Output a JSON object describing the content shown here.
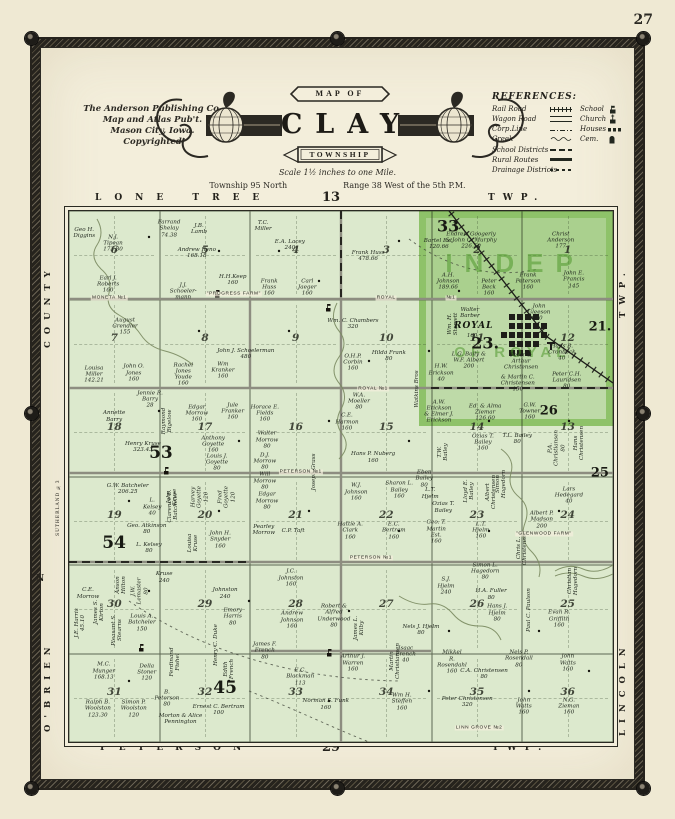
{
  "page": {
    "number": "27"
  },
  "publisher": {
    "line1": "The Anderson Publishing Co.",
    "line2": "Map and Atlas Pub't.",
    "line3": "Mason City, Iowa.",
    "line4": "Copyrighted"
  },
  "title": {
    "map_of": "MAP OF",
    "name": "CLAY",
    "township": "TOWNSHIP",
    "scale": "Scale 1½ inches to one Mile.",
    "township_line": "Township 95 North",
    "range_line": "Range 38 West of the 5th P.M."
  },
  "references": {
    "title": "REFERENCES:",
    "rows": [
      {
        "l": "Rail Road",
        "ls": "rail",
        "r": "School",
        "rs": "school"
      },
      {
        "l": "Wagon Road",
        "ls": "road",
        "r": "Church",
        "rs": "church"
      },
      {
        "l": "Corp.Line",
        "ls": "corp",
        "r": "Houses",
        "rs": "houses"
      },
      {
        "l": "Creek",
        "ls": "creek",
        "r": "Cem.",
        "rs": "cem"
      },
      {
        "l": "School Districts",
        "ls": "district"
      },
      {
        "l": "Rural Routes",
        "ls": "rural"
      },
      {
        "l": "Drainage Districts",
        "ls": "drain"
      }
    ]
  },
  "edges": {
    "top_word": "LONE TREE",
    "top_num": "13",
    "top_twp": "TWP.",
    "bottom_word": "PETERSON",
    "bottom_num": "29",
    "bottom_twp": "TWP.",
    "left_top": "COUNTY",
    "left_bottom": "O'BRIEN",
    "left_small": "SUTHERLAND №3",
    "left_n": "N",
    "right_top": "TWP.",
    "right_bottom": "LINCOLN"
  },
  "map": {
    "overlay": {
      "line1": "INDEP",
      "line2": "OF ROYAL"
    },
    "town": {
      "name": "ROYAL",
      "acres": "160"
    },
    "section_numbers": [
      [
        6,
        5,
        4,
        3,
        2,
        1
      ],
      [
        7,
        8,
        9,
        10,
        11,
        12
      ],
      [
        18,
        17,
        16,
        15,
        14,
        13
      ],
      [
        19,
        20,
        21,
        22,
        23,
        24
      ],
      [
        30,
        29,
        28,
        27,
        26,
        25
      ],
      [
        31,
        32,
        33,
        34,
        35,
        36
      ]
    ],
    "district_numbers": [
      {
        "n": "33",
        "x": 69.7,
        "y": 2.8,
        "s": 16
      },
      {
        "n": "21.",
        "x": 97.6,
        "y": 21.8,
        "s": 13
      },
      {
        "n": "23.",
        "x": 76.5,
        "y": 24.8,
        "s": 16
      },
      {
        "n": "26",
        "x": 88.2,
        "y": 37.6,
        "s": 13
      },
      {
        "n": "25",
        "x": 97.6,
        "y": 49.4,
        "s": 13
      },
      {
        "n": "53",
        "x": 16.9,
        "y": 45.5,
        "s": 17
      },
      {
        "n": "54",
        "x": 8.3,
        "y": 62.6,
        "s": 17
      },
      {
        "n": "45",
        "x": 28.7,
        "y": 89.8,
        "s": 17
      }
    ],
    "road_labels": [
      {
        "t": "MONETA №1",
        "x": 7.4,
        "y": 16.4
      },
      {
        "t": "ROYAL",
        "x": 58.3,
        "y": 16.4
      },
      {
        "t": "№1",
        "x": 70.2,
        "y": 16.4
      },
      {
        "t": "ROYAL №1",
        "x": 55.9,
        "y": 33.5
      },
      {
        "t": "PETERSON №1",
        "x": 42.6,
        "y": 49.1
      },
      {
        "t": "PETERSON №1",
        "x": 55.5,
        "y": 65.4
      },
      {
        "t": "LINN GROVE №2",
        "x": 75.4,
        "y": 97.4
      },
      {
        "t": "\"PROGRESS FARM\"",
        "x": 30.3,
        "y": 15.6
      },
      {
        "t": "\"GLENWOOD FARM\"",
        "x": 87.3,
        "y": 60.9
      }
    ],
    "parcels": [
      {
        "n": "Geo H.|Diggins",
        "x": 2.8,
        "y": 4.1
      },
      {
        "n": "N.J.|Tipean|173.80",
        "x": 8.1,
        "y": 6.2
      },
      {
        "n": "Earl J.|Roberts|160",
        "x": 7.2,
        "y": 13.9
      },
      {
        "n": "Farrand|Shelay|74.38",
        "x": 18.4,
        "y": 3.4
      },
      {
        "n": "J.B.|Lamb",
        "x": 23.9,
        "y": 3.4
      },
      {
        "n": "Andrew Reno|168.18",
        "x": 23.5,
        "y": 7.9
      },
      {
        "n": "J.J.|Schoeler-|mann",
        "x": 21.0,
        "y": 15.2
      },
      {
        "n": "H.H.Keep|160",
        "x": 30.1,
        "y": 13.0
      },
      {
        "n": "T.C.|Miller",
        "x": 35.7,
        "y": 2.8
      },
      {
        "n": "E.A. Lacey|240",
        "x": 40.6,
        "y": 6.4
      },
      {
        "n": "Frank|Huss|160",
        "x": 36.8,
        "y": 14.5
      },
      {
        "n": "Carl|Jaeger|160",
        "x": 43.8,
        "y": 14.5
      },
      {
        "n": "Frank Huss|478.66",
        "x": 55.0,
        "y": 8.5
      },
      {
        "n": "Endrew Googerly|& John C. Murphy|226.50",
        "x": 73.9,
        "y": 5.6
      },
      {
        "n": "Christ|Anderson|177",
        "x": 90.4,
        "y": 5.6
      },
      {
        "n": "Bartel Est.|120.66",
        "x": 68.0,
        "y": 6.2
      },
      {
        "n": "A.H.|Johnson|189.66",
        "x": 69.7,
        "y": 13.3
      },
      {
        "n": "Peter|Beck|160",
        "x": 77.2,
        "y": 14.5
      },
      {
        "n": "Frank|Peterson|160",
        "x": 84.4,
        "y": 13.3
      },
      {
        "n": "John E.|Francis|145",
        "x": 92.8,
        "y": 13.0
      },
      {
        "n": "August|Grendler|155",
        "x": 10.3,
        "y": 21.8
      },
      {
        "n": "John J. Schoelerman|480",
        "x": 32.5,
        "y": 26.9
      },
      {
        "n": "Wm. C. Chambers|320",
        "x": 52.2,
        "y": 21.2
      },
      {
        "n": "Walter|Barber",
        "x": 73.7,
        "y": 19.2
      },
      {
        "n": "John|Gleeson|40",
        "x": 86.4,
        "y": 19.2
      },
      {
        "n": "Wm. H.|Starrett",
        "x": 70.6,
        "y": 21.2,
        "v": 1
      },
      {
        "n": "Louisa|Miller|142.21",
        "x": 4.6,
        "y": 30.8
      },
      {
        "n": "John O.|Jones|160",
        "x": 11.9,
        "y": 30.6
      },
      {
        "n": "Rachel|Jones|Youde|160",
        "x": 21.0,
        "y": 30.8
      },
      {
        "n": "Wm|Kranker|160",
        "x": 28.3,
        "y": 30.1
      },
      {
        "n": "O.H.P.|Corbin|160",
        "x": 52.2,
        "y": 28.6
      },
      {
        "n": "Hilda Frank|80",
        "x": 58.8,
        "y": 27.3
      },
      {
        "n": "W.A.|Moeller|80",
        "x": 53.3,
        "y": 35.9
      },
      {
        "n": "Watkins Bros",
        "x": 64.0,
        "y": 33.5,
        "v": 1
      },
      {
        "n": "H.W.|Erickson|40",
        "x": 68.4,
        "y": 30.6
      },
      {
        "n": "L.G. Baily &|W.F. Albert|200",
        "x": 73.5,
        "y": 28.2
      },
      {
        "n": "Peter &|Arthur|Christensen",
        "x": 83.1,
        "y": 28.4
      },
      {
        "n": "& Martin C.|Christensen|150",
        "x": 82.5,
        "y": 32.5
      },
      {
        "n": "Peter C.H.|Lauridsen|80",
        "x": 91.5,
        "y": 32.0
      },
      {
        "n": "Hans B.|Cronbeck|40",
        "x": 90.6,
        "y": 26.7
      },
      {
        "n": "A.W.|Erickson|& Elmer J.|Erickson",
        "x": 68.0,
        "y": 37.8
      },
      {
        "n": "Ed. & Alma|Ziemar|126.60",
        "x": 76.5,
        "y": 38.0
      },
      {
        "n": "G.W.|Towner|160",
        "x": 84.7,
        "y": 37.8
      },
      {
        "n": "Annette|Barry",
        "x": 8.3,
        "y": 38.7
      },
      {
        "n": "Jennie R.|Barry|28",
        "x": 14.9,
        "y": 35.5
      },
      {
        "n": "Henry Kruse|323.43",
        "x": 13.6,
        "y": 44.4
      },
      {
        "n": "Raymond|Bigelow",
        "x": 18.0,
        "y": 39.5,
        "v": 1
      },
      {
        "n": "Edgar|Morrow|160",
        "x": 23.5,
        "y": 38.2
      },
      {
        "n": "Jule|Franker|160",
        "x": 30.1,
        "y": 37.8
      },
      {
        "n": "Anthony|Goyette|160",
        "x": 26.5,
        "y": 44.0
      },
      {
        "n": "Louis J.|Goyette|80",
        "x": 27.2,
        "y": 47.4
      },
      {
        "n": "Horace E.|Fields|160",
        "x": 36.0,
        "y": 38.2
      },
      {
        "n": "Walter|Morrow|80",
        "x": 36.4,
        "y": 43.2
      },
      {
        "n": "D.J.|Morrow|80",
        "x": 36.0,
        "y": 47.2
      },
      {
        "n": "Will|Morrow|80",
        "x": 36.0,
        "y": 50.9
      },
      {
        "n": "Edgar|Morrow|80",
        "x": 36.4,
        "y": 54.7
      },
      {
        "n": "Joseph Grass",
        "x": 45.0,
        "y": 49.2,
        "v": 1
      },
      {
        "n": "C.E.|Harmon|160",
        "x": 51.1,
        "y": 39.8
      },
      {
        "n": "Hans P. Nuberg|160",
        "x": 55.9,
        "y": 46.4
      },
      {
        "n": "W.J.|Johnson|160",
        "x": 52.8,
        "y": 53.0
      },
      {
        "n": "Sharon L.|Bailey|160",
        "x": 60.7,
        "y": 52.6
      },
      {
        "n": "Eben|Bailey|80",
        "x": 65.3,
        "y": 50.5
      },
      {
        "n": "T.W.|Bailey",
        "x": 68.8,
        "y": 45.3,
        "v": 1
      },
      {
        "n": "L.T.|Hjelm",
        "x": 66.4,
        "y": 53.2
      },
      {
        "n": "Ozias T.|Bailey",
        "x": 68.8,
        "y": 55.8
      },
      {
        "n": "Ozias T.|Bailey|160",
        "x": 76.1,
        "y": 43.6
      },
      {
        "n": "T.L. Bailey|80",
        "x": 82.4,
        "y": 42.9
      },
      {
        "n": "P.A.|Christiansen|80",
        "x": 89.7,
        "y": 44.7,
        "v": 1
      },
      {
        "n": "Hans|Christensen",
        "x": 93.8,
        "y": 43.6,
        "v": 1
      },
      {
        "n": "Lars|Hedegard|40",
        "x": 91.9,
        "y": 53.6
      },
      {
        "n": "Lloyd E.|Bailey",
        "x": 73.5,
        "y": 52.8,
        "v": 1
      },
      {
        "n": "Albert|Christensen",
        "x": 77.6,
        "y": 53.0,
        "v": 1
      },
      {
        "n": "Simon|Hagedorn",
        "x": 79.4,
        "y": 51.4,
        "v": 1
      },
      {
        "n": "L.T.|Hjelm|160",
        "x": 75.7,
        "y": 60.2
      },
      {
        "n": "Albert P.|Madson|200",
        "x": 86.9,
        "y": 58.2
      },
      {
        "n": "Chris L.|Christensen",
        "x": 83.3,
        "y": 63.5,
        "v": 1
      },
      {
        "n": "G.W. Batcheler|206.25",
        "x": 10.8,
        "y": 52.4
      },
      {
        "n": "L.|Kelsey|40",
        "x": 15.3,
        "y": 55.8
      },
      {
        "n": "Clarence E.|Batcheler",
        "x": 19.1,
        "y": 55.6,
        "v": 1
      },
      {
        "n": "Geo. Atkinson|80",
        "x": 14.3,
        "y": 59.8
      },
      {
        "n": "L. Kelsey|80",
        "x": 14.7,
        "y": 63.5
      },
      {
        "n": "John|Kruse",
        "x": 18.9,
        "y": 53.8,
        "v": 1
      },
      {
        "n": "Harvey|Goyette|120",
        "x": 24.1,
        "y": 53.9,
        "v": 1
      },
      {
        "n": "Fred|Goyette|120",
        "x": 29.0,
        "y": 53.9,
        "v": 1
      },
      {
        "n": "Louisa|Kruse",
        "x": 22.8,
        "y": 62.6,
        "v": 1
      },
      {
        "n": "John H.|Snyder|160",
        "x": 27.8,
        "y": 62.0
      },
      {
        "n": "Kruse|240",
        "x": 17.5,
        "y": 69.0
      },
      {
        "n": "Pearley|Morrow",
        "x": 35.8,
        "y": 60.0
      },
      {
        "n": "C.P. Taft",
        "x": 41.2,
        "y": 60.2
      },
      {
        "n": "Hattie A.|Clark|160",
        "x": 51.7,
        "y": 60.3
      },
      {
        "n": "E.C.|Bertram|160",
        "x": 59.7,
        "y": 60.3
      },
      {
        "n": "Geo. T.|Martin|Est.|160",
        "x": 67.5,
        "y": 60.5
      },
      {
        "n": "S.J.|Hjelm|240",
        "x": 69.3,
        "y": 70.7
      },
      {
        "n": "Simon L.|Hagedorn|80",
        "x": 76.5,
        "y": 67.9
      },
      {
        "n": "H.A. Fuller|80",
        "x": 77.6,
        "y": 72.2
      },
      {
        "n": "Hans J.|Hjelm|80",
        "x": 78.7,
        "y": 75.8
      },
      {
        "n": "Christian|Hagedorn",
        "x": 92.6,
        "y": 69.7,
        "v": 1
      },
      {
        "n": "Paul C. Paulson",
        "x": 84.6,
        "y": 75.2,
        "v": 1
      },
      {
        "n": "Evan R.|Griffith|160",
        "x": 90.1,
        "y": 76.9
      },
      {
        "n": "J.C.|Johnston|160",
        "x": 40.8,
        "y": 69.2
      },
      {
        "n": "Johnston|240",
        "x": 28.7,
        "y": 72.0
      },
      {
        "n": "J.E. Harris|45.10",
        "x": 2.0,
        "y": 77.5,
        "v": 1
      },
      {
        "n": "Pleasant S.|Stearns",
        "x": 8.8,
        "y": 79.0,
        "v": 1
      },
      {
        "n": "Anson|Hilton",
        "x": 9.5,
        "y": 70.5,
        "v": 1
      },
      {
        "n": "J.W.|Lemaster|80",
        "x": 13.0,
        "y": 71.5,
        "v": 1
      },
      {
        "n": "C.E.|Morrow",
        "x": 3.5,
        "y": 72.0
      },
      {
        "n": "James S.|Kirton",
        "x": 5.5,
        "y": 75.5,
        "v": 1
      },
      {
        "n": "Louis A.|Batcheler|150",
        "x": 13.4,
        "y": 77.6
      },
      {
        "n": "Emory|Harris|80",
        "x": 30.1,
        "y": 76.5
      },
      {
        "n": "Henry C. Duke",
        "x": 27.0,
        "y": 81.8,
        "v": 1
      },
      {
        "n": "Edith|French",
        "x": 29.4,
        "y": 86.3,
        "v": 1
      },
      {
        "n": "Ferdinand|Fishel",
        "x": 19.5,
        "y": 85.0,
        "v": 1
      },
      {
        "n": "M.C.|Munger|168.13",
        "x": 6.4,
        "y": 86.7
      },
      {
        "n": "Della|Stoner|120",
        "x": 14.3,
        "y": 87.0
      },
      {
        "n": "Ralph B.|Woolston|123.30",
        "x": 5.3,
        "y": 93.8
      },
      {
        "n": "Simon P.|Woolston|120",
        "x": 11.9,
        "y": 93.8
      },
      {
        "n": "B.|Peterson|80",
        "x": 18.0,
        "y": 91.9
      },
      {
        "n": "Morton & Alice|Pennington",
        "x": 20.5,
        "y": 95.7
      },
      {
        "n": "Ernest C. Bertram|100",
        "x": 27.5,
        "y": 94.0
      },
      {
        "n": "Andrew|Johnson|160",
        "x": 41.0,
        "y": 77.1
      },
      {
        "n": "Robert &|Alfred|Underwood|80",
        "x": 48.7,
        "y": 76.3
      },
      {
        "n": "James L.|Kilby",
        "x": 53.3,
        "y": 78.6,
        "v": 1
      },
      {
        "n": "James F.|French|80",
        "x": 36.0,
        "y": 82.9
      },
      {
        "n": "E.C.|Blackman|113",
        "x": 42.5,
        "y": 87.8
      },
      {
        "n": "Arthur J.|Warren|160",
        "x": 52.2,
        "y": 85.2
      },
      {
        "n": "Norman S. Funk|160",
        "x": 47.2,
        "y": 92.9
      },
      {
        "n": "Martin|Christiansen",
        "x": 59.9,
        "y": 84.8,
        "v": 1
      },
      {
        "n": "Nels J. Hjelm|80",
        "x": 64.7,
        "y": 78.9
      },
      {
        "n": "Isaac|French|40",
        "x": 61.9,
        "y": 83.6
      },
      {
        "n": "Mikkel|R.|Rosendahl|160",
        "x": 70.4,
        "y": 85.0
      },
      {
        "n": "Wm H.|Steffen|160",
        "x": 61.2,
        "y": 92.5
      },
      {
        "n": "Peter Christensen|320",
        "x": 73.2,
        "y": 92.5
      },
      {
        "n": "John|Watts|160",
        "x": 83.6,
        "y": 93.4
      },
      {
        "n": "N.G.|Zieman|160",
        "x": 91.9,
        "y": 93.4
      },
      {
        "n": "John|Watts|160",
        "x": 91.7,
        "y": 85.2
      },
      {
        "n": "Nels P.|Rosendall|80",
        "x": 82.7,
        "y": 84.4
      },
      {
        "n": "C.A. Christensen|80",
        "x": 76.3,
        "y": 87.2
      }
    ]
  },
  "colors": {
    "paper": "#f3eedb",
    "map_green": "#dce9cd",
    "highlight_green": "#7cc24e",
    "frame_dark": "#2b2923",
    "ink": "#22271f"
  }
}
